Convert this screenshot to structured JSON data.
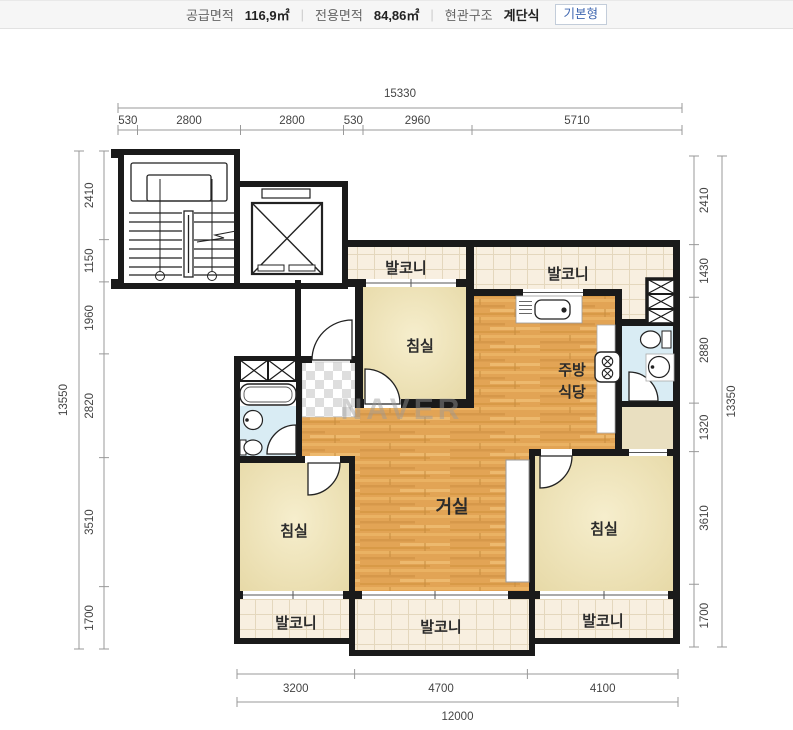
{
  "header": {
    "supply_label": "공급면적",
    "supply_value": "116,9㎡",
    "exclusive_label": "전용면적",
    "exclusive_value": "84,86㎡",
    "entrance_label": "현관구조",
    "entrance_value": "계단식",
    "separator": "|",
    "badge": "기본형"
  },
  "watermark": "NAVER",
  "rooms": {
    "living": "거실",
    "kitchen_line1": "주방",
    "kitchen_line2": "식당",
    "bedroom": "침실",
    "balcony": "발코니"
  },
  "dimensions": {
    "top": {
      "total": "15330",
      "segments": [
        "530",
        "2800",
        "2800",
        "530",
        "2960",
        "5710"
      ]
    },
    "bottom": {
      "total": "12000",
      "segments": [
        "3200",
        "4700",
        "4100"
      ]
    },
    "left": {
      "total": "13550",
      "segments": [
        "2410",
        "1150",
        "1960",
        "2820",
        "3510",
        "1700"
      ]
    },
    "right": {
      "total": "13350",
      "segments": [
        "2410",
        "1430",
        "2880",
        "1320",
        "3610",
        "1700"
      ]
    }
  },
  "colors": {
    "wall": "#1a1a1a",
    "wood_floor": "#e2a455",
    "bedroom_fill": "#e9dbab",
    "balcony_tile": "#f8efe0",
    "bathroom_fill": "#d9ecf4",
    "badge_text": "#3e66b0"
  }
}
